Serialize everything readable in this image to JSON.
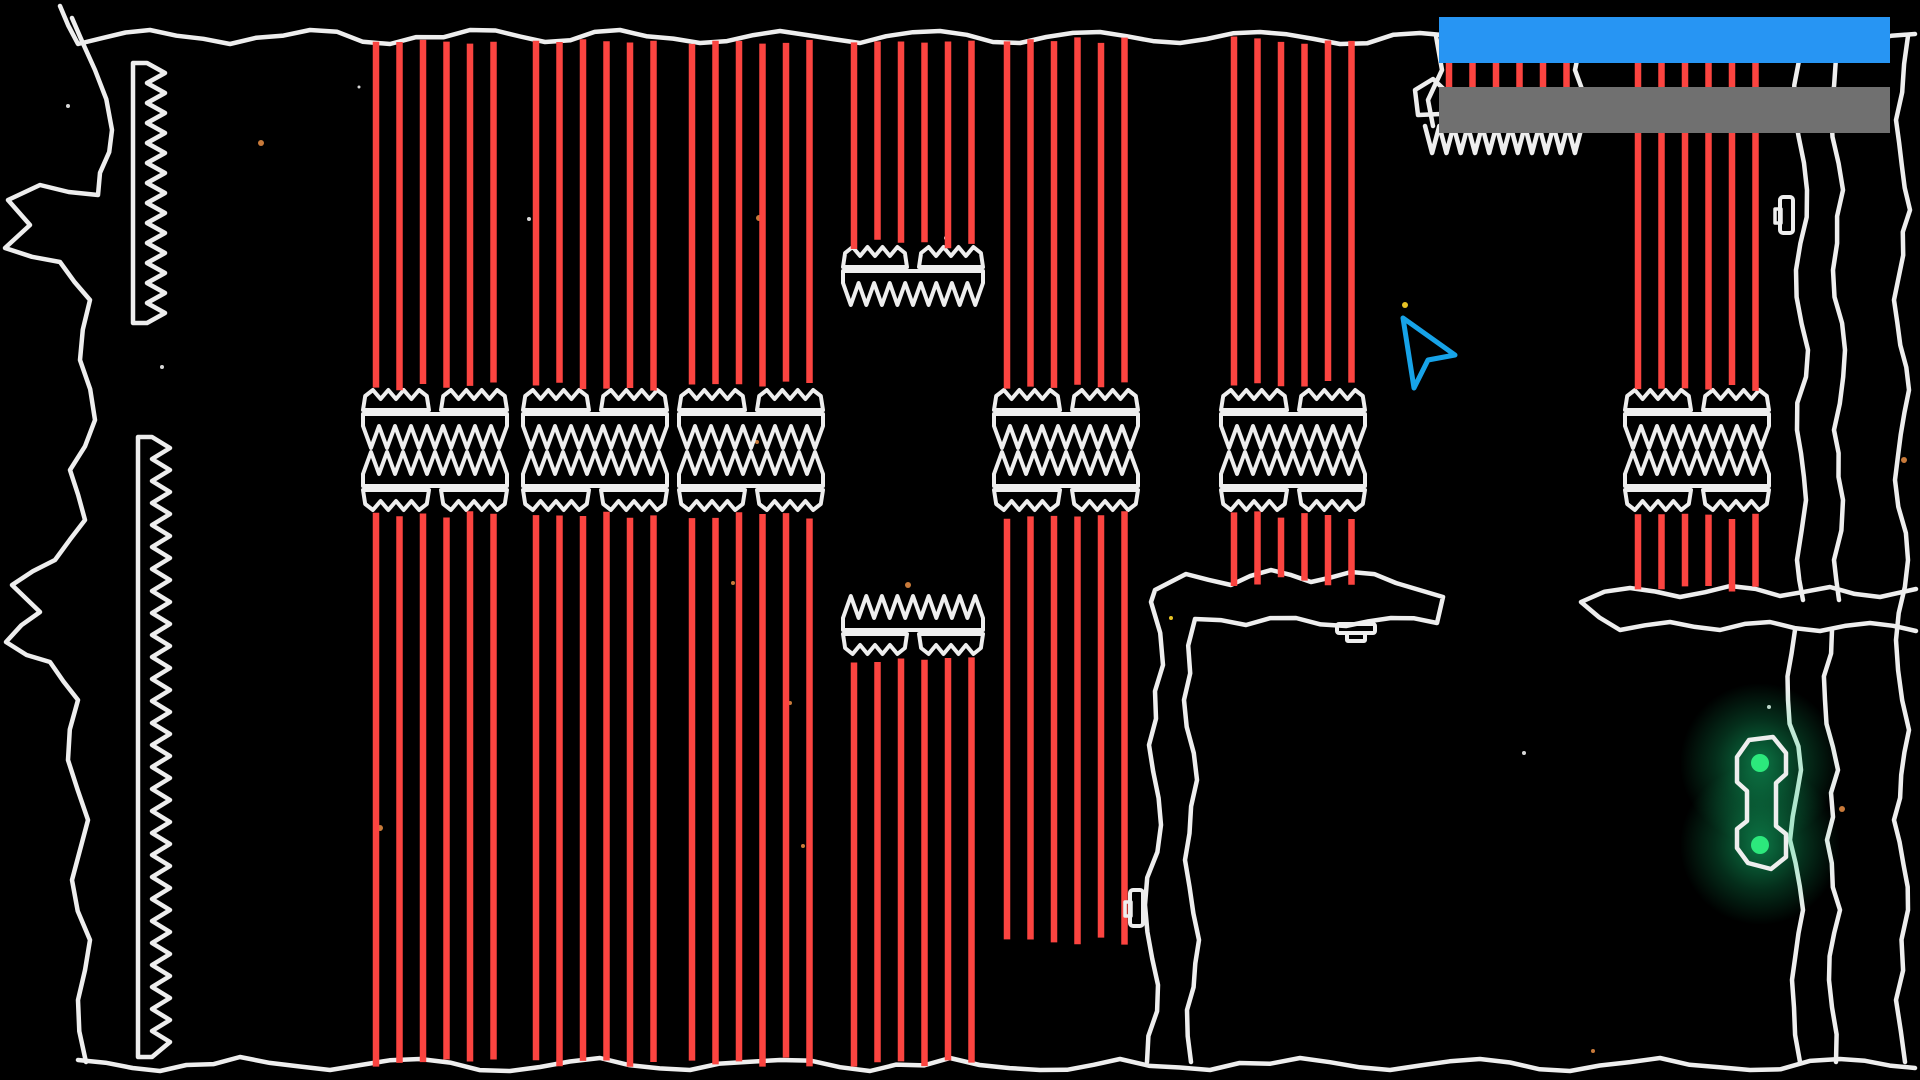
{
  "scene": {
    "width": 1920,
    "height": 1080,
    "background": "#000000"
  },
  "colors": {
    "terrain": "#eeeeee",
    "laser": "#fb4440",
    "bar_blue": "#2795f3",
    "bar_gray": "#707070",
    "cursor": "#17a3e8",
    "handle_green": "#2ce87c",
    "glow_green": "#15d67d",
    "orange": "#c87a3a",
    "yellow": "#e8c325",
    "white": "#d8d8d8"
  },
  "hud": {
    "bars": [
      {
        "name": "top-bar",
        "color_key": "bar_blue",
        "x": 1439,
        "y": 17,
        "width": 451,
        "height": 46
      },
      {
        "name": "bottom-bar",
        "color_key": "bar_gray",
        "x": 1439,
        "y": 87,
        "width": 451,
        "height": 46
      }
    ]
  },
  "cursor": {
    "points": [
      [
        1403,
        318
      ],
      [
        1455,
        355
      ],
      [
        1428,
        360
      ],
      [
        1414,
        388
      ]
    ],
    "stroke_width": 5
  },
  "lasers": {
    "width": 6.5,
    "groups": [
      {
        "name": "A",
        "x": 376,
        "count": 6,
        "spacing": 23.5,
        "segments": [
          [
            40,
            386
          ],
          [
            515,
            1062
          ]
        ]
      },
      {
        "name": "B",
        "x": 536,
        "count": 6,
        "spacing": 23.5,
        "segments": [
          [
            40,
            386
          ],
          [
            515,
            1062
          ]
        ]
      },
      {
        "name": "C",
        "x": 692,
        "count": 6,
        "spacing": 23.5,
        "segments": [
          [
            40,
            386
          ],
          [
            515,
            1062
          ]
        ]
      },
      {
        "name": "D",
        "x": 854,
        "count": 6,
        "spacing": 23.5,
        "segments": [
          [
            40,
            244
          ],
          [
            660,
            1062
          ]
        ]
      },
      {
        "name": "E",
        "x": 1007,
        "count": 6,
        "spacing": 23.5,
        "segments": [
          [
            40,
            386
          ],
          [
            515,
            941
          ]
        ]
      },
      {
        "name": "F",
        "x": 1234,
        "count": 6,
        "spacing": 23.5,
        "segments": [
          [
            40,
            386
          ],
          [
            515,
            582
          ]
        ]
      },
      {
        "name": "G",
        "x": 1449,
        "count": 6,
        "spacing": 23.5,
        "segments": [
          [
            40,
            128
          ]
        ]
      },
      {
        "name": "H",
        "x": 1638,
        "count": 6,
        "spacing": 23.5,
        "segments": [
          [
            40,
            386
          ],
          [
            515,
            588
          ]
        ]
      }
    ]
  },
  "gates": [
    {
      "x": 363,
      "y": 388,
      "w": 144,
      "parts": [
        [
          "crown-top",
          0
        ],
        [
          "band-down",
          26
        ],
        [
          "band-up",
          64
        ],
        [
          "crown-bottom",
          102
        ]
      ]
    },
    {
      "x": 523,
      "y": 388,
      "w": 144,
      "parts": [
        [
          "crown-top",
          0
        ],
        [
          "band-down",
          26
        ],
        [
          "band-up",
          64
        ],
        [
          "crown-bottom",
          102
        ]
      ]
    },
    {
      "x": 679,
      "y": 388,
      "w": 144,
      "parts": [
        [
          "crown-top",
          0
        ],
        [
          "band-down",
          26
        ],
        [
          "band-up",
          64
        ],
        [
          "crown-bottom",
          102
        ]
      ]
    },
    {
      "x": 994,
      "y": 388,
      "w": 144,
      "parts": [
        [
          "crown-top",
          0
        ],
        [
          "band-down",
          26
        ],
        [
          "band-up",
          64
        ],
        [
          "crown-bottom",
          102
        ]
      ]
    },
    {
      "x": 1221,
      "y": 388,
      "w": 144,
      "parts": [
        [
          "crown-top",
          0
        ],
        [
          "band-down",
          26
        ],
        [
          "band-up",
          64
        ],
        [
          "crown-bottom",
          102
        ]
      ]
    },
    {
      "x": 1625,
      "y": 388,
      "w": 144,
      "parts": [
        [
          "crown-top",
          0
        ],
        [
          "band-down",
          26
        ],
        [
          "band-up",
          64
        ],
        [
          "crown-bottom",
          102
        ]
      ]
    },
    {
      "x": 843,
      "y": 245,
      "w": 140,
      "parts": [
        [
          "crown-top",
          0
        ],
        [
          "band-down",
          26
        ]
      ]
    },
    {
      "x": 843,
      "y": 596,
      "w": 140,
      "parts": [
        [
          "band-up",
          0
        ],
        [
          "crown-bottom",
          38
        ]
      ]
    }
  ],
  "spike_strips": [
    {
      "x": 147,
      "y": 63,
      "length": 260,
      "bar_width": 14,
      "depth": 18,
      "pitch": 20
    },
    {
      "x": 152,
      "y": 437,
      "length": 620,
      "bar_width": 14,
      "depth": 18,
      "pitch": 22
    }
  ],
  "ceiling_spike_row": {
    "x1": 1425,
    "x2": 1582,
    "y": 126,
    "depth": 27,
    "teeth": 11
  },
  "terrain_paths": [
    {
      "name": "ceiling",
      "closed": false,
      "points": [
        [
          60,
          6
        ],
        [
          78,
          44
        ],
        [
          150,
          30
        ],
        [
          230,
          44
        ],
        [
          310,
          30
        ],
        [
          390,
          44
        ],
        [
          470,
          30
        ],
        [
          545,
          42
        ],
        [
          620,
          30
        ],
        [
          700,
          43
        ],
        [
          780,
          31
        ],
        [
          860,
          43
        ],
        [
          940,
          31
        ],
        [
          1020,
          43
        ],
        [
          1100,
          32
        ],
        [
          1180,
          43
        ],
        [
          1260,
          32
        ],
        [
          1340,
          44
        ],
        [
          1420,
          33
        ],
        [
          1500,
          44
        ],
        [
          1580,
          32
        ],
        [
          1660,
          44
        ],
        [
          1740,
          33
        ],
        [
          1820,
          44
        ],
        [
          1915,
          34
        ]
      ]
    },
    {
      "name": "left-wall",
      "closed": false,
      "points": [
        [
          72,
          18
        ],
        [
          95,
          70
        ],
        [
          112,
          130
        ],
        [
          98,
          195
        ],
        [
          40,
          185
        ],
        [
          8,
          200
        ],
        [
          30,
          225
        ],
        [
          5,
          248
        ],
        [
          60,
          262
        ],
        [
          90,
          300
        ],
        [
          80,
          360
        ],
        [
          95,
          420
        ],
        [
          70,
          470
        ],
        [
          85,
          520
        ],
        [
          55,
          560
        ],
        [
          12,
          585
        ],
        [
          40,
          612
        ],
        [
          6,
          642
        ],
        [
          50,
          662
        ],
        [
          78,
          700
        ],
        [
          68,
          760
        ],
        [
          88,
          820
        ],
        [
          72,
          880
        ],
        [
          90,
          940
        ],
        [
          78,
          1000
        ],
        [
          86,
          1062
        ]
      ]
    },
    {
      "name": "floor",
      "closed": false,
      "points": [
        [
          78,
          1060
        ],
        [
          160,
          1071
        ],
        [
          240,
          1057
        ],
        [
          330,
          1070
        ],
        [
          420,
          1059
        ],
        [
          510,
          1071
        ],
        [
          600,
          1058
        ],
        [
          690,
          1070
        ],
        [
          780,
          1060
        ],
        [
          870,
          1071
        ],
        [
          950,
          1058
        ],
        [
          1040,
          1070
        ],
        [
          1120,
          1059
        ],
        [
          1210,
          1070
        ],
        [
          1300,
          1058
        ],
        [
          1390,
          1070
        ],
        [
          1480,
          1059
        ],
        [
          1570,
          1071
        ],
        [
          1660,
          1058
        ],
        [
          1750,
          1070
        ],
        [
          1840,
          1059
        ],
        [
          1915,
          1068
        ]
      ]
    },
    {
      "name": "right-wall",
      "closed": false,
      "points": [
        [
          1908,
          36
        ],
        [
          1896,
          120
        ],
        [
          1910,
          210
        ],
        [
          1894,
          300
        ],
        [
          1909,
          390
        ],
        [
          1895,
          480
        ],
        [
          1908,
          560
        ],
        [
          1896,
          640
        ],
        [
          1909,
          730
        ],
        [
          1894,
          820
        ],
        [
          1908,
          910
        ],
        [
          1896,
          1000
        ],
        [
          1905,
          1062
        ]
      ]
    },
    {
      "name": "cave-left-wall",
      "closed": false,
      "points": [
        [
          1147,
          1062
        ],
        [
          1158,
          985
        ],
        [
          1145,
          905
        ],
        [
          1161,
          825
        ],
        [
          1149,
          745
        ],
        [
          1163,
          665
        ],
        [
          1151,
          602
        ],
        [
          1155,
          590
        ],
        [
          1186,
          574
        ],
        [
          1231,
          585
        ],
        [
          1271,
          570
        ],
        [
          1311,
          582
        ],
        [
          1351,
          572
        ],
        [
          1396,
          583
        ],
        [
          1443,
          597
        ],
        [
          1437,
          623
        ],
        [
          1391,
          618
        ],
        [
          1346,
          626
        ],
        [
          1296,
          618
        ],
        [
          1246,
          625
        ],
        [
          1195,
          619
        ],
        [
          1184,
          700
        ],
        [
          1197,
          780
        ],
        [
          1185,
          860
        ],
        [
          1199,
          940
        ],
        [
          1187,
          1010
        ],
        [
          1191,
          1062
        ]
      ]
    },
    {
      "name": "right-plateau",
      "closed": false,
      "points": [
        [
          1916,
          589
        ],
        [
          1880,
          597
        ],
        [
          1830,
          587
        ],
        [
          1780,
          596
        ],
        [
          1730,
          586
        ],
        [
          1680,
          597
        ],
        [
          1630,
          588
        ],
        [
          1581,
          602
        ],
        [
          1620,
          630
        ],
        [
          1670,
          622
        ],
        [
          1720,
          630
        ],
        [
          1770,
          622
        ],
        [
          1820,
          631
        ],
        [
          1870,
          623
        ],
        [
          1916,
          631
        ]
      ]
    },
    {
      "name": "channel-left-edge",
      "closed": false,
      "points": [
        [
          1802,
          36
        ],
        [
          1794,
          110
        ],
        [
          1807,
          190
        ],
        [
          1796,
          270
        ],
        [
          1808,
          350
        ],
        [
          1797,
          430
        ],
        [
          1806,
          500
        ],
        [
          1797,
          560
        ],
        [
          1803,
          600
        ]
      ]
    },
    {
      "name": "channel-right-edge",
      "closed": false,
      "points": [
        [
          1838,
          36
        ],
        [
          1831,
          110
        ],
        [
          1843,
          190
        ],
        [
          1833,
          270
        ],
        [
          1845,
          350
        ],
        [
          1834,
          430
        ],
        [
          1843,
          500
        ],
        [
          1834,
          560
        ],
        [
          1839,
          600
        ]
      ]
    },
    {
      "name": "cave-right-wall-inner",
      "closed": false,
      "points": [
        [
          1795,
          630
        ],
        [
          1788,
          700
        ],
        [
          1801,
          770
        ],
        [
          1790,
          840
        ],
        [
          1803,
          910
        ],
        [
          1792,
          980
        ],
        [
          1800,
          1062
        ]
      ]
    },
    {
      "name": "cave-right-wall-outer",
      "closed": false,
      "points": [
        [
          1832,
          630
        ],
        [
          1825,
          700
        ],
        [
          1838,
          770
        ],
        [
          1827,
          840
        ],
        [
          1840,
          910
        ],
        [
          1829,
          980
        ],
        [
          1836,
          1062
        ]
      ]
    },
    {
      "name": "hanging-rock-left-edge",
      "closed": false,
      "points": [
        [
          1436,
          36
        ],
        [
          1442,
          70
        ],
        [
          1428,
          100
        ],
        [
          1433,
          126
        ]
      ]
    },
    {
      "name": "hanging-rock-right-edge",
      "closed": false,
      "points": [
        [
          1582,
          36
        ],
        [
          1575,
          70
        ],
        [
          1586,
          100
        ],
        [
          1578,
          126
        ]
      ]
    },
    {
      "name": "small-rock",
      "closed": true,
      "points": [
        [
          1415,
          90
        ],
        [
          1433,
          79
        ],
        [
          1448,
          93
        ],
        [
          1441,
          114
        ],
        [
          1418,
          115
        ]
      ]
    }
  ],
  "stars": [
    [
      261,
      143,
      "orange",
      3
    ],
    [
      68,
      106,
      "white",
      2
    ],
    [
      162,
      367,
      "white",
      2
    ],
    [
      759,
      218,
      "orange",
      3
    ],
    [
      529,
      219,
      "white",
      2
    ],
    [
      757,
      442,
      "orange",
      2
    ],
    [
      908,
      585,
      "orange",
      3
    ],
    [
      790,
      703,
      "orange",
      2
    ],
    [
      380,
      828,
      "orange",
      3
    ],
    [
      803,
      846,
      "orange",
      2
    ],
    [
      733,
      583,
      "orange",
      2
    ],
    [
      1405,
      305,
      "yellow",
      3
    ],
    [
      1171,
      618,
      "yellow",
      2
    ],
    [
      1904,
      460,
      "orange",
      3
    ],
    [
      1524,
      753,
      "white",
      2
    ],
    [
      1842,
      809,
      "orange",
      3
    ],
    [
      1769,
      707,
      "white",
      2
    ],
    [
      1593,
      1051,
      "orange",
      2
    ],
    [
      946,
      238,
      "white",
      2
    ],
    [
      359,
      87,
      "white",
      1.5
    ]
  ],
  "handle": {
    "outline": [
      [
        1749,
        740
      ],
      [
        1773,
        737
      ],
      [
        1786,
        753
      ],
      [
        1786,
        774
      ],
      [
        1776,
        783
      ],
      [
        1776,
        826
      ],
      [
        1786,
        834
      ],
      [
        1786,
        857
      ],
      [
        1771,
        869
      ],
      [
        1748,
        863
      ],
      [
        1737,
        848
      ],
      [
        1737,
        829
      ],
      [
        1747,
        821
      ],
      [
        1747,
        791
      ],
      [
        1737,
        782
      ],
      [
        1737,
        757
      ]
    ],
    "nodes": [
      [
        1760,
        763
      ],
      [
        1760,
        845
      ]
    ],
    "node_radius": 9,
    "glow_radius": 80
  },
  "wall_sockets": [
    {
      "x": 1780,
      "y": 197,
      "w": 13,
      "h": 36
    },
    {
      "x": 1130,
      "y": 890,
      "w": 13,
      "h": 36
    }
  ],
  "ground_button": {
    "x": 1337,
    "y": 624,
    "w": 38,
    "h": 9,
    "inner_w": 18,
    "inner_h": 8
  }
}
